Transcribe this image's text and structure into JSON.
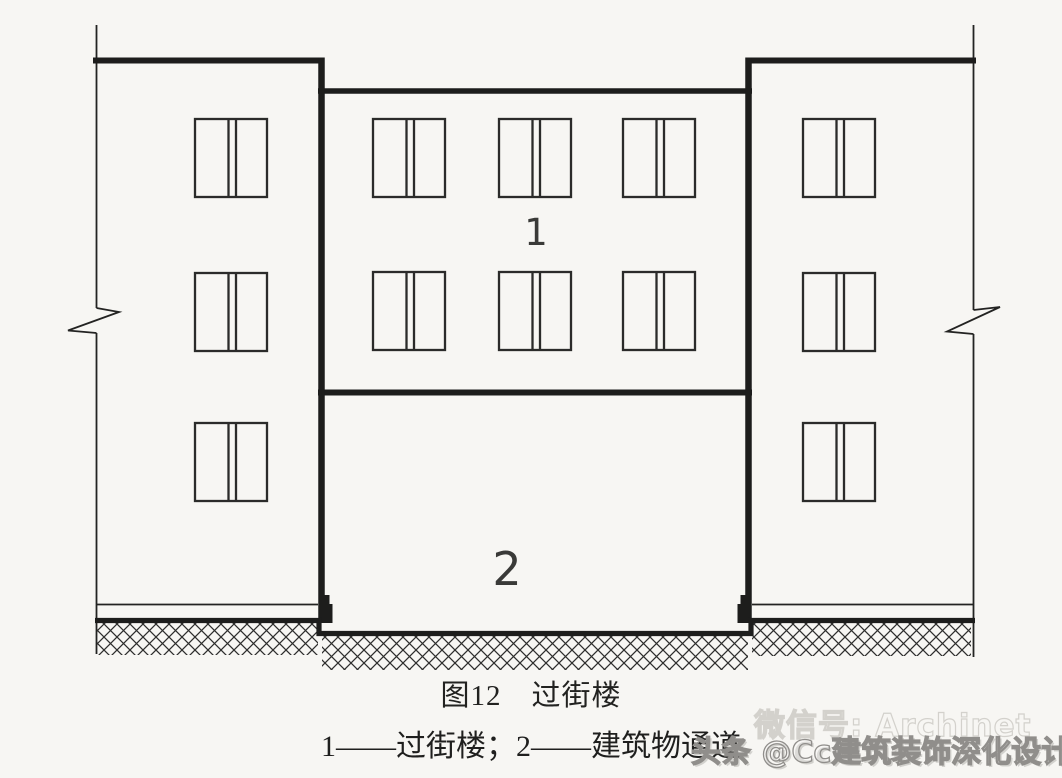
{
  "figure": {
    "caption_line1": "图12　过街楼",
    "caption_line2": "1——过街楼；2——建筑物通道",
    "figure_number": "图12",
    "figure_title": "过街楼",
    "legend": [
      {
        "key": "1",
        "label": "过街楼"
      },
      {
        "key": "2",
        "label": "建筑物通道"
      }
    ]
  },
  "diagram": {
    "type": "architectural-elevation",
    "label_overpass": "1",
    "label_passage": "2",
    "structure": {
      "left_building": {
        "window_rows": 3,
        "window_cols": 1,
        "has_break_symbol": true
      },
      "center_overpass": {
        "window_rows": 2,
        "window_cols": 3
      },
      "right_building": {
        "window_rows": 3,
        "window_cols": 1,
        "has_break_symbol": true
      },
      "ground": "hatched earth, passage floor recessed below side ground level"
    }
  },
  "watermark": {
    "wechat_line": "微信号: Archinet",
    "account_line": "头条 @Cc建筑装饰深化设计"
  },
  "colors": {
    "background": "#f7f6f3",
    "line": "#1d1d1c",
    "window_line": "#2b2b2a",
    "label_text": "#3a3a38",
    "caption_text": "#222220",
    "watermark_light": "#d3d1cc",
    "watermark_dark": "#908e8b"
  }
}
